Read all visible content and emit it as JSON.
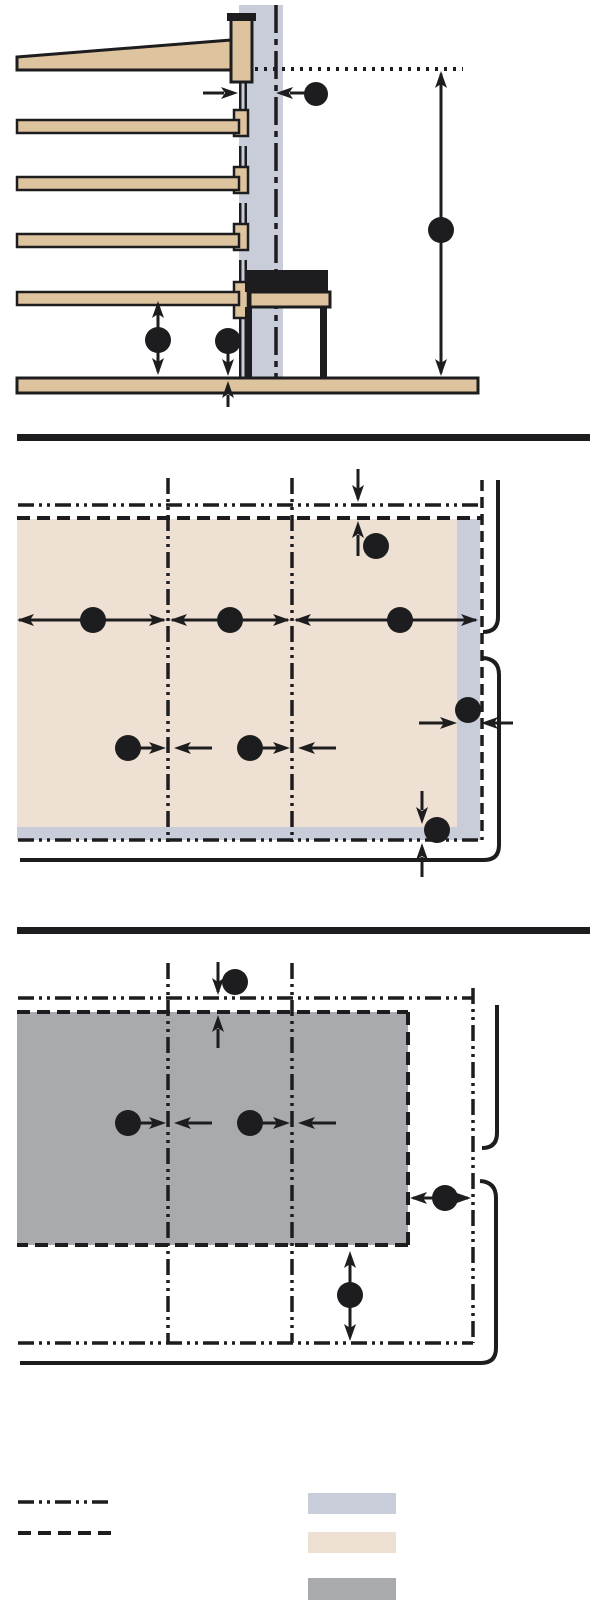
{
  "figure": {
    "kind": "architectural-dimension-diagram",
    "panel_count": 3,
    "panels": [
      {
        "id": "section-elevation",
        "description": "building section with five floor slabs, curtain wall, bench and ground slab, five circular dimension callouts"
      },
      {
        "id": "plan-upper-slab",
        "description": "plan view of slab (beige) against wall with column grid lines, nine circular dimension callouts"
      },
      {
        "id": "plan-equipment-zone",
        "description": "plan view of equipment zone (gray) with column grid lines, six circular dimension callouts"
      }
    ],
    "callout_total": 20
  },
  "colors": {
    "ink": "#1d1d1f",
    "paper": "#ffffff",
    "wall": "#c9cdda",
    "slab_section": "#ddc39e",
    "slab_plan": "#eee1d3",
    "equipment_gray": "#a9aaad"
  },
  "legend": {
    "line_samples": [
      {
        "name": "centerline-sample",
        "style": "dash-dot-dot"
      },
      {
        "name": "hidden-line-sample",
        "style": "dashed"
      }
    ],
    "swatches": [
      {
        "name": "wall-swatch",
        "fill": "#c9cdda"
      },
      {
        "name": "slab-swatch",
        "fill": "#eee1d3"
      },
      {
        "name": "equipment-swatch",
        "fill": "#a9aaad"
      }
    ]
  }
}
